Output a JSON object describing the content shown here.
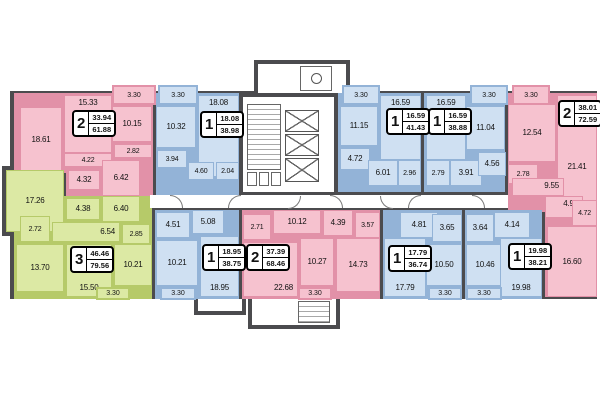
{
  "colors": {
    "wall": "#4b4b4e",
    "pink": "#f6c2cf",
    "pink_line": "#e291a8",
    "blue": "#cfe0f2",
    "blue_line": "#93b3d7",
    "green": "#dce9a4",
    "green_line": "#b6ca69"
  },
  "apartments": [
    {
      "id": "a1",
      "color": "pink",
      "type": "2",
      "living": "33.94",
      "total": "61.88",
      "balcony": "3.30",
      "rooms": {
        "living1": "18.61",
        "living2": "15.33",
        "kitchen": "10.15",
        "hall": "4.22",
        "bath": "4.32",
        "corridor": "6.42",
        "wc": "2.82"
      }
    },
    {
      "id": "a2",
      "color": "blue",
      "type": "1",
      "living": "18.08",
      "total": "38.98",
      "balcony": "3.30",
      "rooms": {
        "living": "18.08",
        "kitchen": "10.32",
        "bath": "3.94",
        "hall": "4.60",
        "wc": "2.04"
      }
    },
    {
      "id": "a3",
      "color": "blue",
      "type": "1",
      "living": "16.59",
      "total": "41.43",
      "balcony": "3.30",
      "rooms": {
        "living": "16.59",
        "kitchen": "11.15",
        "bath": "4.72",
        "hall": "6.01",
        "wc": "2.96"
      }
    },
    {
      "id": "a4",
      "color": "blue",
      "type": "1",
      "living": "16.59",
      "total": "38.88",
      "balcony": "3.30",
      "rooms": {
        "living": "16.59",
        "kitchen": "11.04",
        "wc": "2.79",
        "hall": "3.91",
        "bath": "4.56"
      }
    },
    {
      "id": "a5",
      "color": "pink",
      "type": "2",
      "living": "38.01",
      "total": "72.59",
      "balcony": "3.30",
      "rooms": {
        "kitchen": "12.54",
        "living1": "21.41",
        "living2": "16.60",
        "corridor": "9.55",
        "bath": "4.98",
        "wc": "2.78",
        "hall": "4.72"
      }
    },
    {
      "id": "a6",
      "color": "green",
      "type": "3",
      "living": "46.46",
      "total": "79.56",
      "balcony": "3.30",
      "rooms": {
        "living1": "17.26",
        "living2": "13.70",
        "living3": "15.50",
        "wardrobe": "2.72",
        "bath": "4.38",
        "corridor1": "6.40",
        "corridor2": "6.54",
        "wc": "2.85",
        "kitchen": "10.21"
      }
    },
    {
      "id": "a7",
      "color": "blue",
      "type": "1",
      "living": "18.95",
      "total": "38.75",
      "balcony": "3.30",
      "rooms": {
        "living": "18.95",
        "kitchen": "10.21",
        "bath": "4.51",
        "hall": "5.08"
      }
    },
    {
      "id": "a8",
      "color": "pink",
      "type": "2",
      "living": "37.39",
      "total": "68.46",
      "balcony": "3.30",
      "rooms": {
        "living1": "22.68",
        "living2": "14.73",
        "kitchen": "10.27",
        "hall": "10.12",
        "wardrobe": "2.71",
        "bath": "4.39",
        "wc": "3.57"
      }
    },
    {
      "id": "a9",
      "color": "blue",
      "type": "1",
      "living": "17.79",
      "total": "36.74",
      "balcony": "3.30",
      "rooms": {
        "living": "17.79",
        "kitchen": "10.50",
        "hall": "4.81",
        "bath": "3.65"
      }
    },
    {
      "id": "a10",
      "color": "blue",
      "type": "1",
      "living": "19.98",
      "total": "38.21",
      "balcony": "3.30",
      "rooms": {
        "living": "19.98",
        "kitchen": "10.46",
        "hall": "4.14",
        "bath": "3.64"
      }
    }
  ]
}
